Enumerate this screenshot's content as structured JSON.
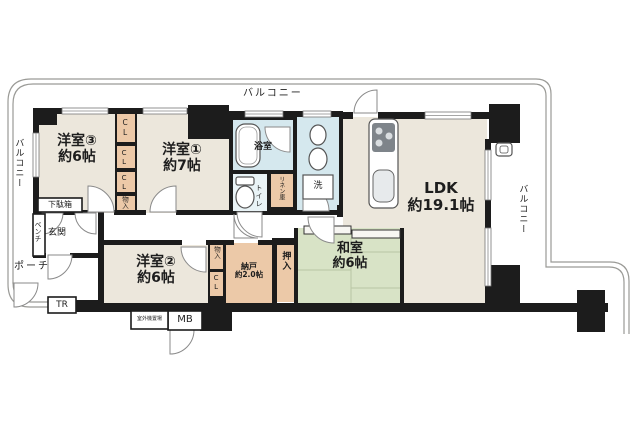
{
  "fp": {
    "balconies": {
      "top": "バルコニー",
      "left": "バルコニー",
      "right": "バルコニー"
    },
    "rooms": {
      "yo3_name": "洋室③",
      "yo3_size": "約6帖",
      "yo1_name": "洋室①",
      "yo1_size": "約7帖",
      "yo2_name": "洋室②",
      "yo2_size": "約6帖",
      "ldk_name": "LDK",
      "ldk_size": "約19.1帖",
      "washitsu_name": "和室",
      "washitsu_size": "約6帖",
      "nando_name": "納戸",
      "nando_size": "約2.0帖",
      "bath": "浴室",
      "toilet": "トイレ",
      "linen": "リネン庫",
      "genkan": "玄関",
      "porch": "ポーチ"
    },
    "storage": {
      "cl1": "CL",
      "cl2": "CL",
      "cl3": "CL",
      "monoire1": "物入",
      "monoire2": "物入",
      "cl4": "CL",
      "oshiire": "押入"
    },
    "fixtures": {
      "getabako": "下駄箱",
      "bench": "ベンチ",
      "tr": "TR",
      "mb": "MB",
      "outdoor_unit": "室外機置場",
      "laundry": "洗"
    },
    "colors": {
      "wall": "#1c1c1c",
      "room_beige": "#ece7dc",
      "tatami_green": "#d8e3c6",
      "wet_blue": "#d5e8ee",
      "closet_orange": "#ecc9a8",
      "rail_gray": "#9a9a96"
    }
  }
}
